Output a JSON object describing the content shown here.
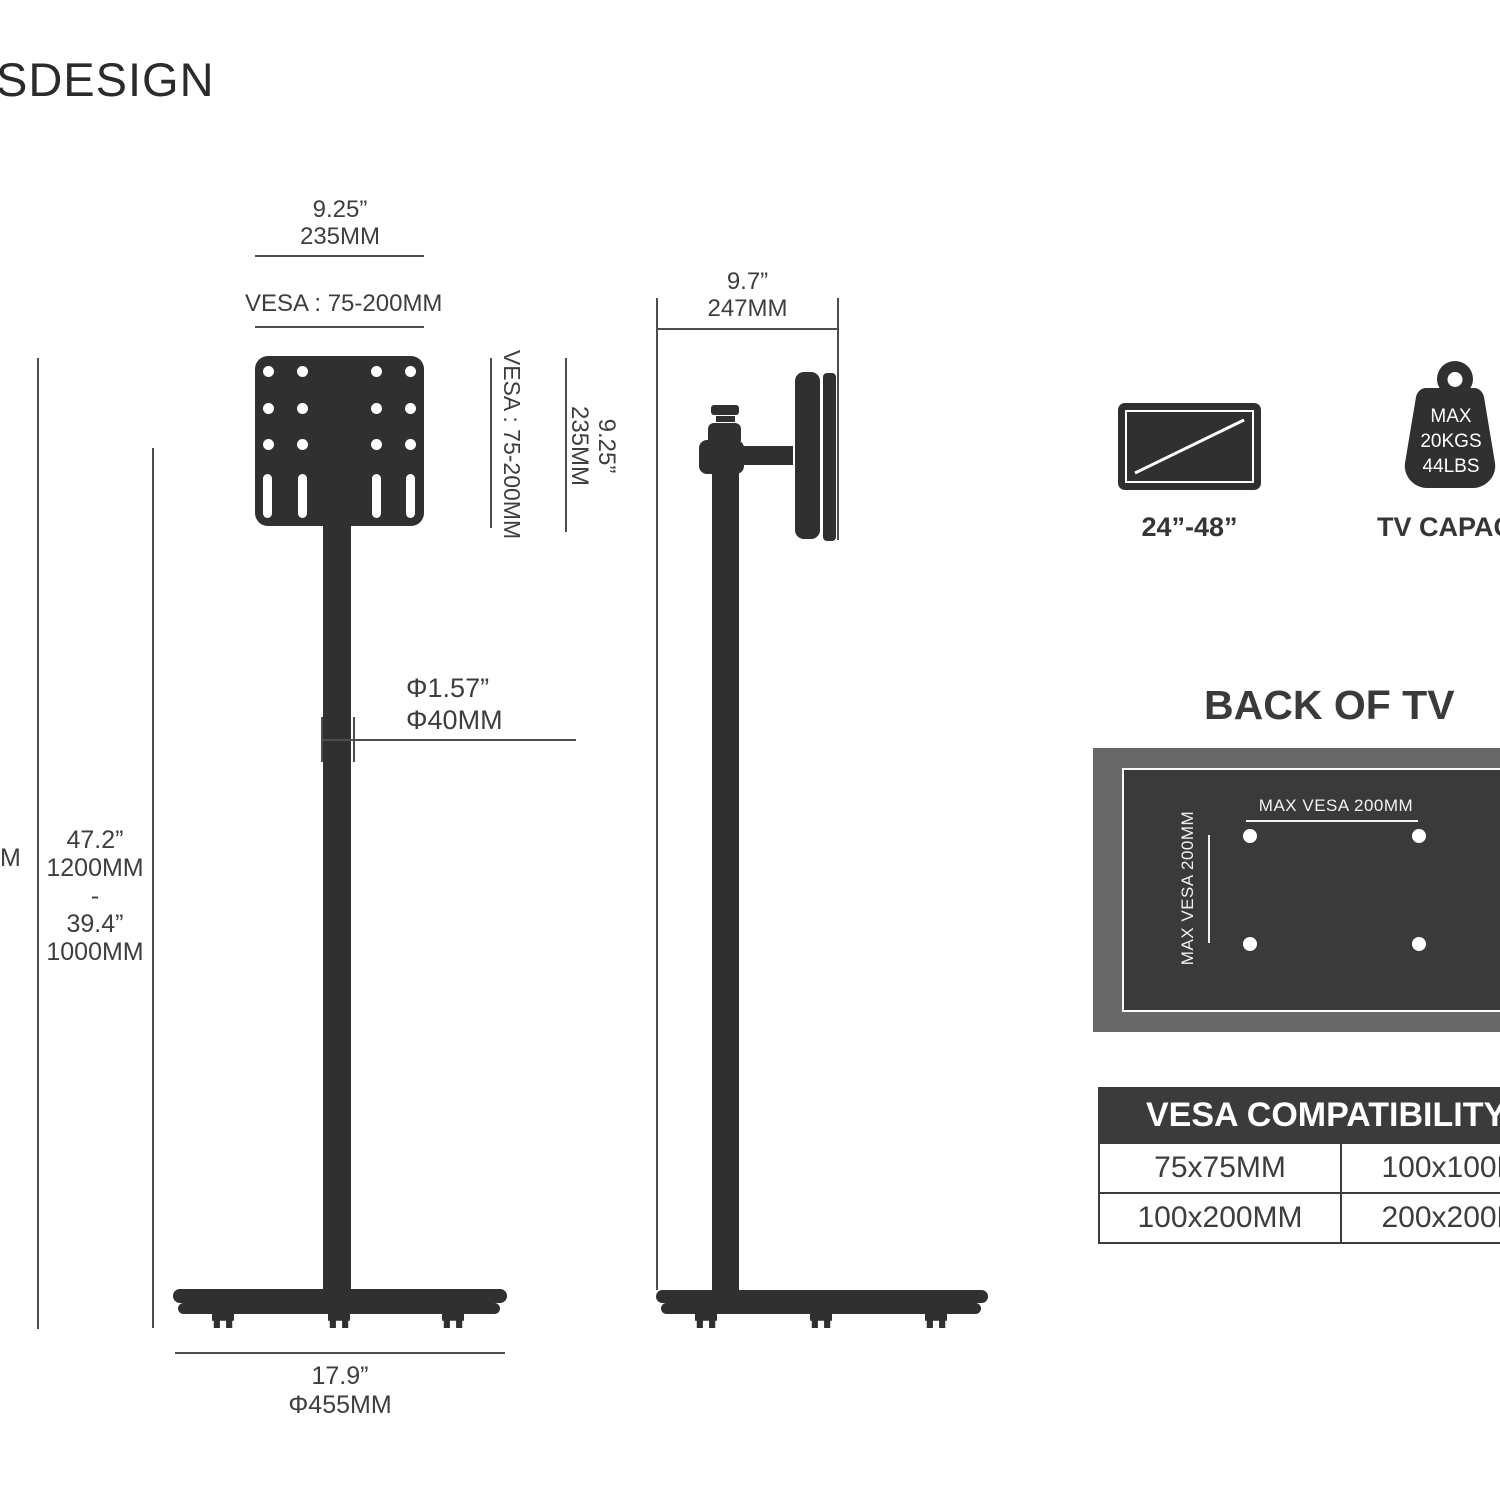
{
  "logo": {
    "text": "SDESIGN"
  },
  "front_view": {
    "top_width": {
      "inch": "9.25”",
      "mm": "235MM"
    },
    "vesa_range_top": "VESA : 75-200MM",
    "vesa_range_side": "VESA : 75-200MM",
    "plate_height": {
      "inch": "9.25”",
      "mm": "235MM"
    },
    "pole_diameter": {
      "inch": "Φ1.57”",
      "mm": "Φ40MM"
    },
    "height_range": {
      "max_inch": "47.2”",
      "max_mm": "1200MM",
      "separator": "-",
      "min_inch": "39.4”",
      "min_mm": "1000MM"
    },
    "edge_cut_label": "M",
    "base_width": {
      "inch": "17.9”",
      "mm": "Φ455MM"
    }
  },
  "side_view": {
    "depth": {
      "inch": "9.7”",
      "mm": "247MM"
    }
  },
  "tv_size_badge": {
    "label": "24”-48”"
  },
  "capacity_badge": {
    "max": "MAX",
    "kgs": "20KGS",
    "lbs": "44LBS",
    "label": "TV CAPACITY"
  },
  "back_of_tv": {
    "title": "BACK OF TV",
    "max_vesa_horizontal": "MAX VESA 200MM",
    "max_vesa_vertical": "MAX VESA 200MM"
  },
  "vesa_table": {
    "title": "VESA COMPATIBILITY",
    "rows": [
      [
        "75x75MM",
        "100x100MM"
      ],
      [
        "100x200MM",
        "200x200MM"
      ]
    ]
  }
}
